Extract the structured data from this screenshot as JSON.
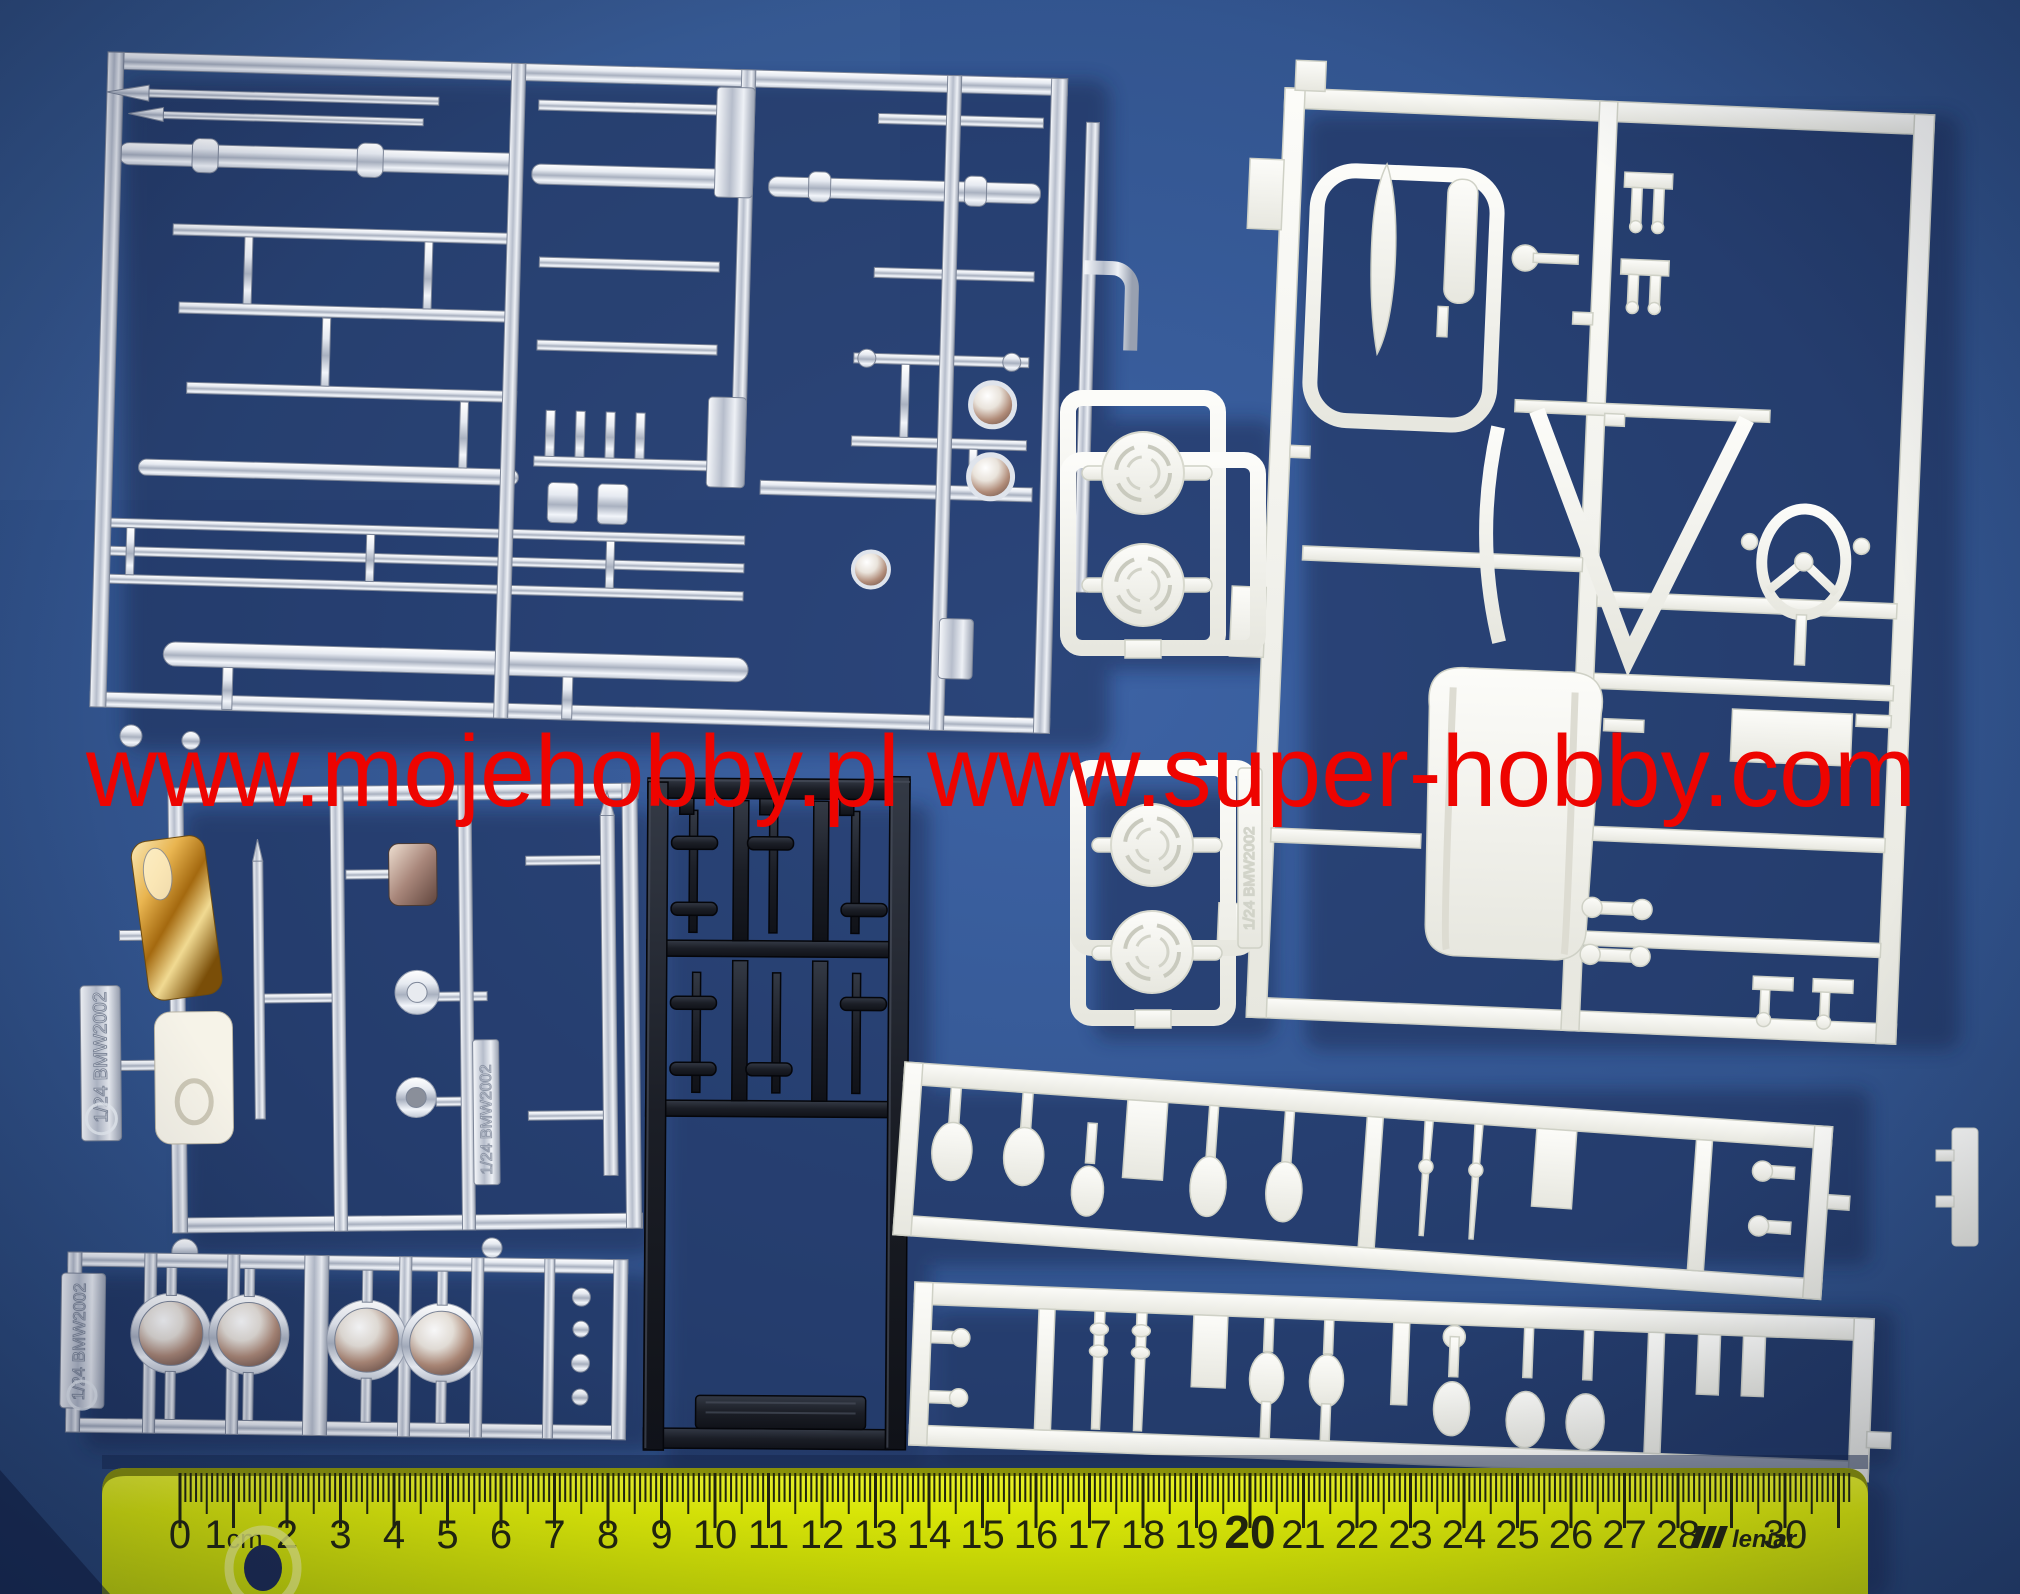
{
  "photo": {
    "subject": "1/24 scale BMW 2002 model kit sprues on blue background",
    "background_color": "#32548c"
  },
  "watermark": {
    "text": "www.mojehobby.pl www.super-hobby.com",
    "color": "#ee0400"
  },
  "ruler": {
    "color": "#e6f304",
    "number_color": "#23260a",
    "cm_labels": [
      "0",
      "1cm",
      "2",
      "3",
      "4",
      "5",
      "6",
      "7",
      "8",
      "9",
      "10",
      "11",
      "12",
      "13",
      "14",
      "15",
      "16",
      "17",
      "18",
      "19",
      "20",
      "21",
      "22",
      "23",
      "24",
      "25",
      "26",
      "27",
      "28",
      "",
      "30"
    ],
    "emphasized_label": "20",
    "brand_prefix": "///",
    "brand": "leniar",
    "brand_at_cm": 29
  },
  "sprues": {
    "chrome_trim": {
      "name": "chrome trim and bumpers sprue",
      "material": "chrome"
    },
    "chrome_detail": {
      "name": "chrome mirrors and plates sprue",
      "material": "chrome",
      "tag": "1/24 BMW2002"
    },
    "chrome_headlights": {
      "name": "chrome headlights sprue",
      "material": "chrome",
      "tag": "1/24 BMW2002"
    },
    "black_parts": {
      "name": "black small parts sprue",
      "material": "black"
    },
    "white_interior": {
      "name": "white interior and chassis sprue",
      "material": "white"
    },
    "white_wheels_upper": {
      "name": "white wheel backs sprue upper",
      "material": "white"
    },
    "white_wheels_lower": {
      "name": "white wheel backs sprue lower",
      "material": "white",
      "tag": "1/24 BMW2002"
    },
    "white_strip_upper": {
      "name": "white small parts strip upper",
      "material": "white"
    },
    "white_strip_lower": {
      "name": "white small parts strip lower",
      "material": "white"
    }
  },
  "colors": {
    "chrome_light": "#f4f7fb",
    "chrome_mid": "#c3cad6",
    "chrome_dark": "#8d95a6",
    "white_plastic": "#f3f3ee",
    "black_plastic": "#1c1f26",
    "gold": "#c08a30",
    "ruler_yellow": "#e6f304"
  }
}
